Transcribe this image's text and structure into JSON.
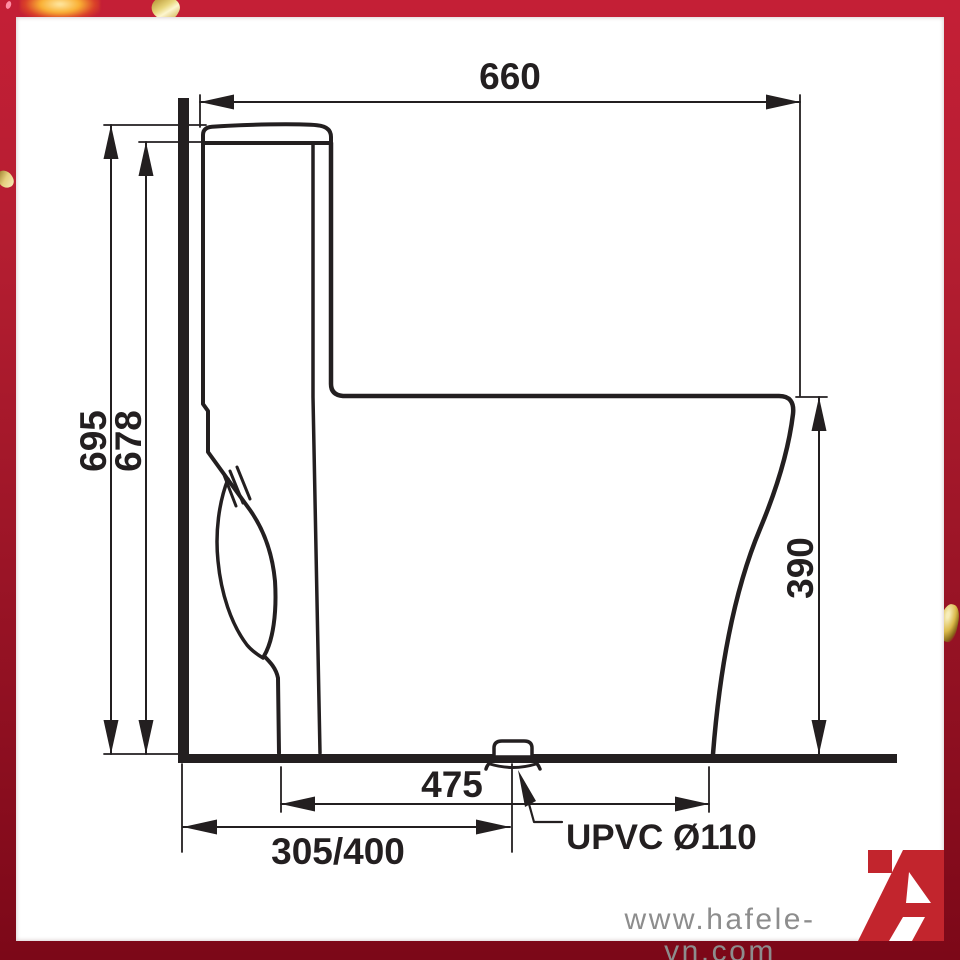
{
  "drawing": {
    "type": "toilet-side-elevation-technical-drawing",
    "line_color": "#231f20",
    "labels": {
      "overall_width": "660",
      "overall_height": "695",
      "tank_top_height": "678",
      "bowl_rim_height": "390",
      "bowl_depth_at_floor": "475",
      "rough_in_distance": "305/400",
      "outlet_pipe": "UPVC Ø110"
    }
  },
  "footer": {
    "watermark": "www.hafele-vn.com",
    "watermark_color": "#8d8d8d"
  },
  "logo": {
    "name": "hafele-logo",
    "color": "#c2252d"
  },
  "frame": {
    "border_color_top": "#c41f36",
    "border_color_bottom": "#7c0818",
    "confetti_gold": "#dcbc52",
    "confetti_glow": "#f9b034"
  }
}
